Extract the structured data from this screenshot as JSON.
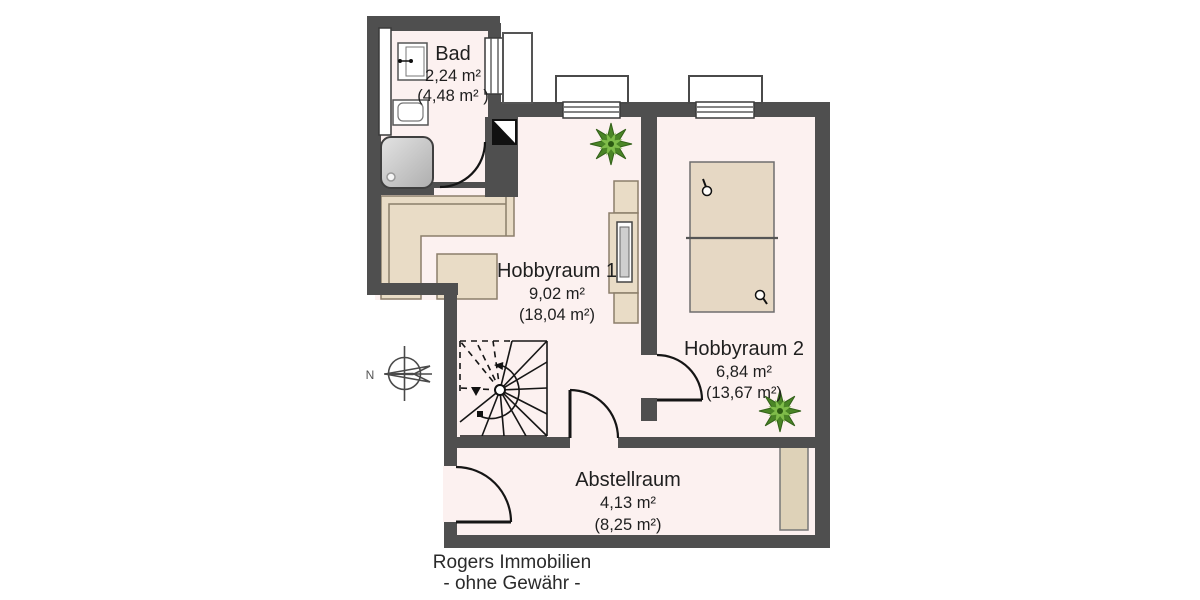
{
  "branding": {
    "company": "Rogers Immobilien",
    "disclaimer": "- ohne Gewähr -"
  },
  "compass": {
    "north_label": "N"
  },
  "rooms": {
    "bad": {
      "name": "Bad",
      "area": "2,24 m²",
      "area_total": "(4,48 m² )"
    },
    "hobbyraum1": {
      "name": "Hobbyraum 1",
      "area": "9,02 m²",
      "area_total": "(18,04 m²)"
    },
    "hobbyraum2": {
      "name": "Hobbyraum 2",
      "area": "6,84 m²",
      "area_total": "(13,67 m²)"
    },
    "abstellraum": {
      "name": "Abstellraum",
      "area": "4,13 m²",
      "area_total": "(8,25 m²)"
    }
  },
  "colors": {
    "wall": "#4f4f4f",
    "floor": "#fcf1f0",
    "furniture": "#e9dcc6",
    "furniture_border": "#8b7e6a",
    "plant_dark": "#4a8526",
    "plant_light": "#7fbc4a",
    "line": "#1f1f1f"
  },
  "icons": [
    "compass-icon",
    "spiral-stairs-icon",
    "shower-icon",
    "sink-icon",
    "toilet-icon",
    "bed-icon",
    "reading-lamp-icon",
    "sofa-icon",
    "coffee-table-icon",
    "cabinet-icon",
    "wardrobe-icon",
    "plant-icon",
    "chimney-icon",
    "window-icon",
    "door-swing-icon"
  ]
}
